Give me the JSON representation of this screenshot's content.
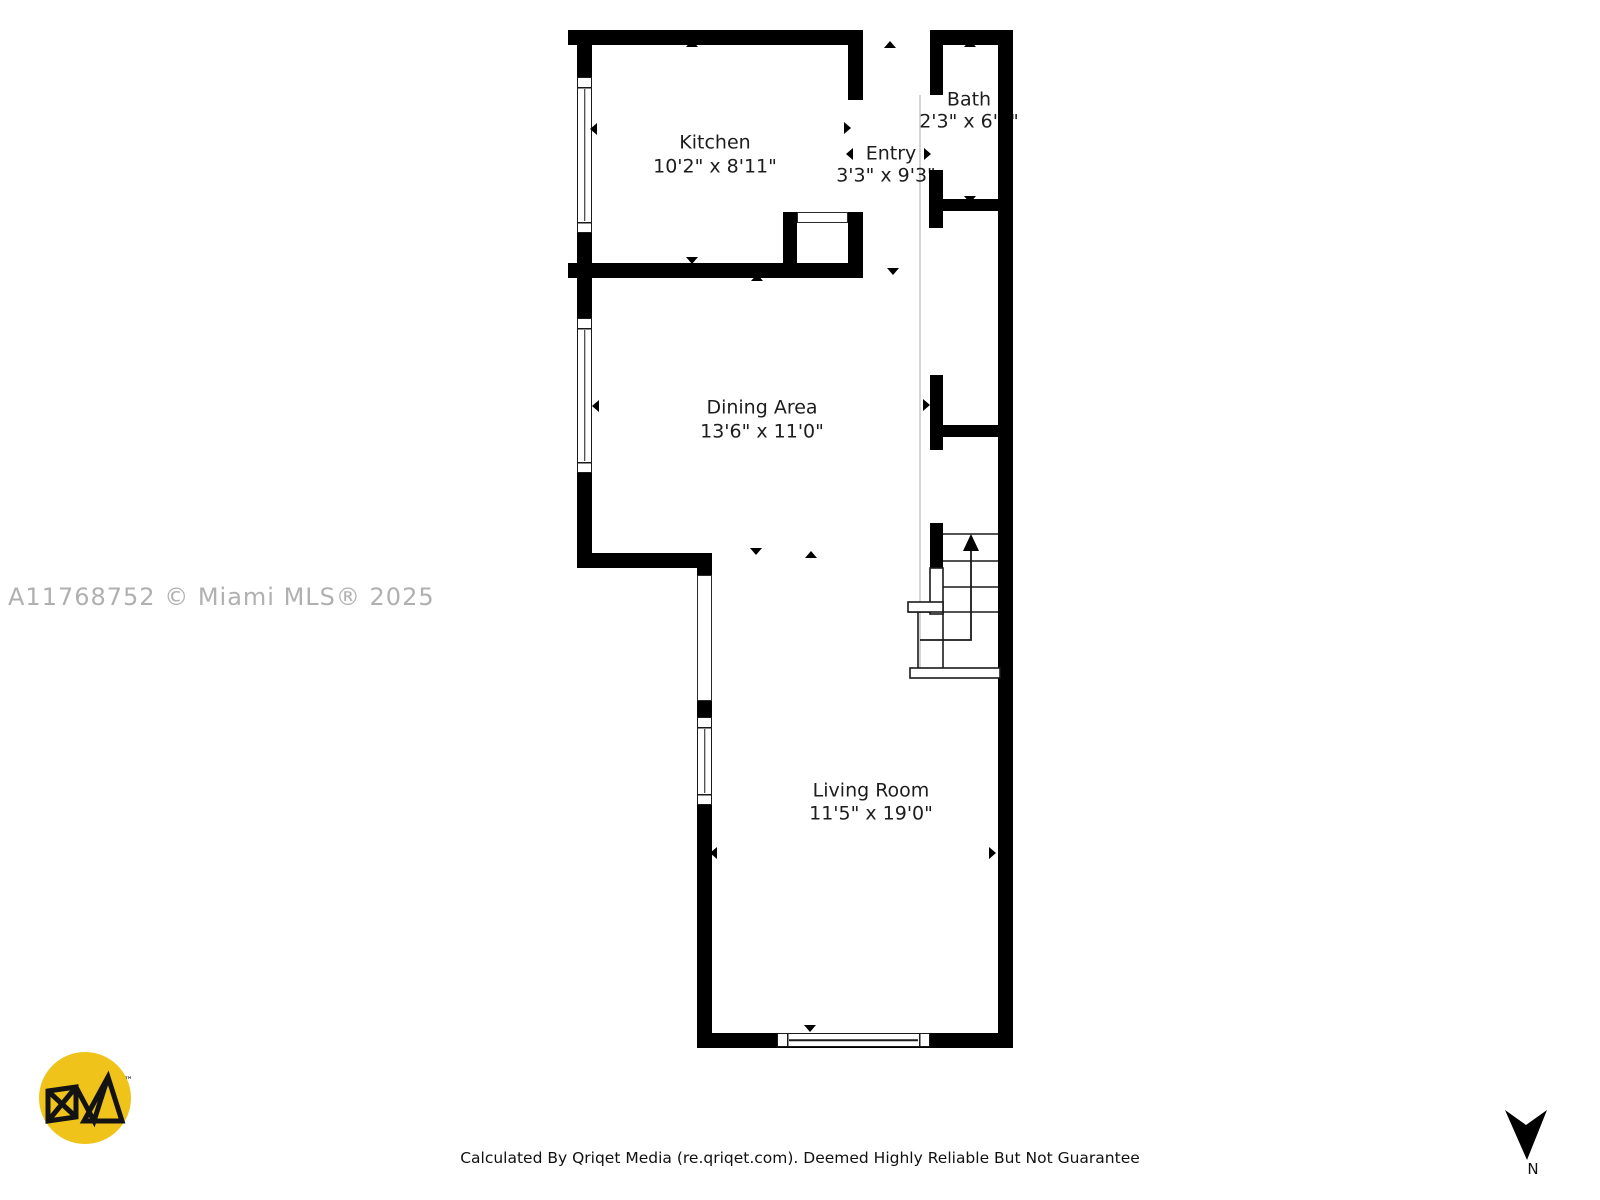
{
  "plan": {
    "rooms": [
      {
        "name": "Kitchen",
        "dims": "10'2\" x 8'11\""
      },
      {
        "name": "Entry",
        "dims": "3'3\" x 9'3\""
      },
      {
        "name": "Bath",
        "dims": "2'3\" x 6'5\""
      },
      {
        "name": "Dining Area",
        "dims": "13'6\" x 11'0\""
      },
      {
        "name": "Living Room",
        "dims": "11'5\" x 19'0\""
      }
    ],
    "features": [
      "stairs-up-arrow",
      "windows",
      "door-markers"
    ]
  },
  "watermark": "A11768752 © Miami MLS® 2025",
  "footer": "Calculated By Qriqet Media (re.qriqet.com). Deemed Highly Reliable But Not Guarantee",
  "compass": {
    "label": "N"
  },
  "logo": {
    "trademark": "™"
  },
  "colors": {
    "wall": "#000000",
    "watermark_gray": "#b0b0b0",
    "logo_yellow": "#efc31a",
    "corridor_line": "#d4d4d4"
  }
}
